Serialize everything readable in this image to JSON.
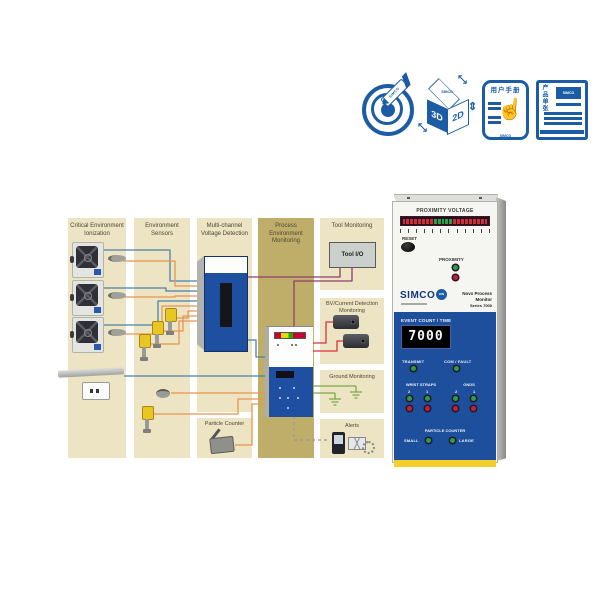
{
  "icons": {
    "target": {
      "brand": "SIMCO"
    },
    "cube": {
      "top_brand": "SIMCO",
      "left": "3D",
      "right": "2D"
    },
    "manual": {
      "title": "用户手册",
      "brand": "SIMCO"
    },
    "sheet": {
      "title": "产品单张",
      "brand": "SIMCO"
    }
  },
  "diagram": {
    "columns": [
      {
        "label": "Critical Environment Ionization"
      },
      {
        "label": "Environment Sensors"
      },
      {
        "label": "Multi-channel Voltage Detection"
      },
      {
        "label": "Process Environment Monitoring",
        "highlight": true
      },
      {
        "label": "Tool Monitoring"
      }
    ],
    "labels": {
      "tool_io": "Tool I/O",
      "bv_current": "BV/Current Detection Monitoring",
      "ground": "Ground Monitoring",
      "particle_counter": "Particle Counter",
      "alerts": "Alerts"
    }
  },
  "product": {
    "proximity_voltage_label": "PROXIMITY VOLTAGE",
    "reset_label": "RESET",
    "proximity_label": "PROXIMITY",
    "brand": "SIMCO",
    "brand_ion": "ION",
    "model_name": "Novx Process Monitor",
    "model_series": "Series 7000",
    "event_count_label": "EVENT COUNT / TIME",
    "display_value": "7000",
    "transmit_label": "TRANSMIT",
    "com_fault_label": "COM / FAULT",
    "wrist_straps_label": "WRIST STRAPS",
    "gnds_label": "GNDS",
    "channel_2": "2",
    "channel_1": "1",
    "particle_counter_label": "PARTICLE COUNTER",
    "small_label": "SMALL",
    "large_label": "LARGE",
    "bargraph": {
      "red_left": 8,
      "green": 5,
      "red_right": 9,
      "tick_count": 12
    }
  },
  "colors": {
    "icon_blue": "#1b5ca5",
    "column_tan": "#ece4c3",
    "column_highlight": "#bfae69",
    "device_blue": "#1f4fa0",
    "line_blue": "#4a82a8",
    "line_orange": "#e8944e",
    "line_purple": "#8e3f6b",
    "line_red": "#d93040",
    "line_green": "#7ba946",
    "panel_blue": "#1d4f9c",
    "stripe_yellow": "#f2cf2a"
  }
}
